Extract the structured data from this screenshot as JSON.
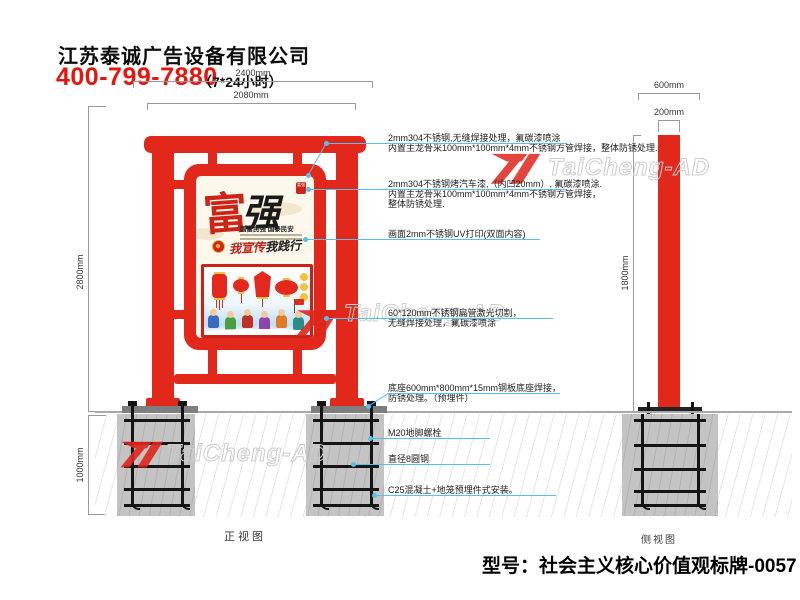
{
  "header": {
    "company": "江苏泰诚广告设备有限公司",
    "phone": "400-799-7880",
    "hours": "（7*24小时）"
  },
  "watermark": {
    "brand": "TaiCheng-AD"
  },
  "dimensions": {
    "front_total_width": "2400mm",
    "front_panel_width": "2080mm",
    "front_height": "2800mm",
    "front_foundation_depth": "1000mm",
    "side_base_width": "600mm",
    "side_pole_width": "200mm",
    "side_pole_height": "1800mm"
  },
  "views": {
    "front_label": "正视图",
    "side_label": "侧视图"
  },
  "poster": {
    "title_char_1": "富",
    "title_char_2": "强",
    "seal_text": "富强",
    "subtitle": "国富民强 国泰民安",
    "slogan_prefix": "我宣传",
    "slogan_suffix": "我践行"
  },
  "annotations": [
    {
      "lines": [
        "2mm304不锈钢,无缝焊接处理，氟碳漆喷涂",
        "内置主龙骨采100mm*100mm*4mm不锈钢方管焊接，整体防锈处理."
      ]
    },
    {
      "lines": [
        "2mm304不锈钢烤汽车漆,（内凹20mm）, 氟碳漆喷涂.",
        "内置主龙骨采100mm*100mm*4mm不锈钢方管焊接，",
        "整体防锈处理."
      ]
    },
    {
      "lines": [
        "画面2mm不锈钢UV打印(双面内容)"
      ]
    },
    {
      "lines": [
        "60*120mm不锈钢扁管激光切割，",
        "无缝焊接处理，氟碳漆喷涂"
      ]
    },
    {
      "lines": [
        "底座600mm*800mm*15mm钢板底座焊接，",
        "防锈处理。（预埋件）"
      ]
    },
    {
      "lines": [
        "M20地脚螺栓"
      ]
    },
    {
      "lines": [
        "直径8圆钢"
      ]
    },
    {
      "lines": [
        "C25混凝土+地笼预埋件式安装。"
      ]
    }
  ],
  "footer": {
    "model": "型号：社会主义核心价值观标牌-0057"
  },
  "colors": {
    "accent_red": "#e2271b",
    "leader_blue": "#56c1ee",
    "phone_red": "#e8150d"
  }
}
